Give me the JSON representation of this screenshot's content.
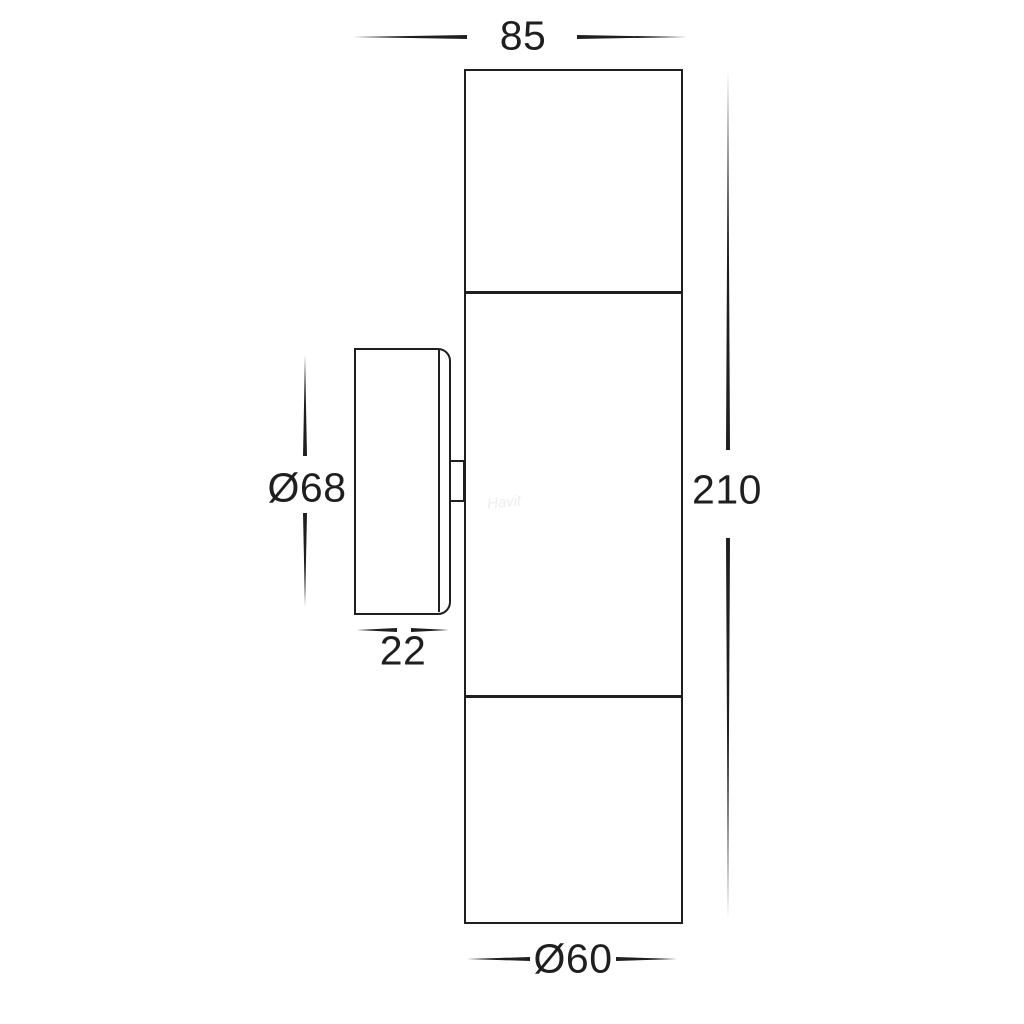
{
  "colors": {
    "line": "#1f1f1f",
    "text": "#1f1f1f",
    "bg": "#ffffff"
  },
  "diagram": {
    "type": "technical-dimension-drawing",
    "subject": "up/down wall pillar light — front elevation and mounting plate side view",
    "watermark": "Havit",
    "dims": {
      "top_width": "85",
      "overall_height": "210",
      "backplate_diameter": "Ø68",
      "backplate_depth": "22",
      "body_diameter": "Ø60"
    }
  }
}
